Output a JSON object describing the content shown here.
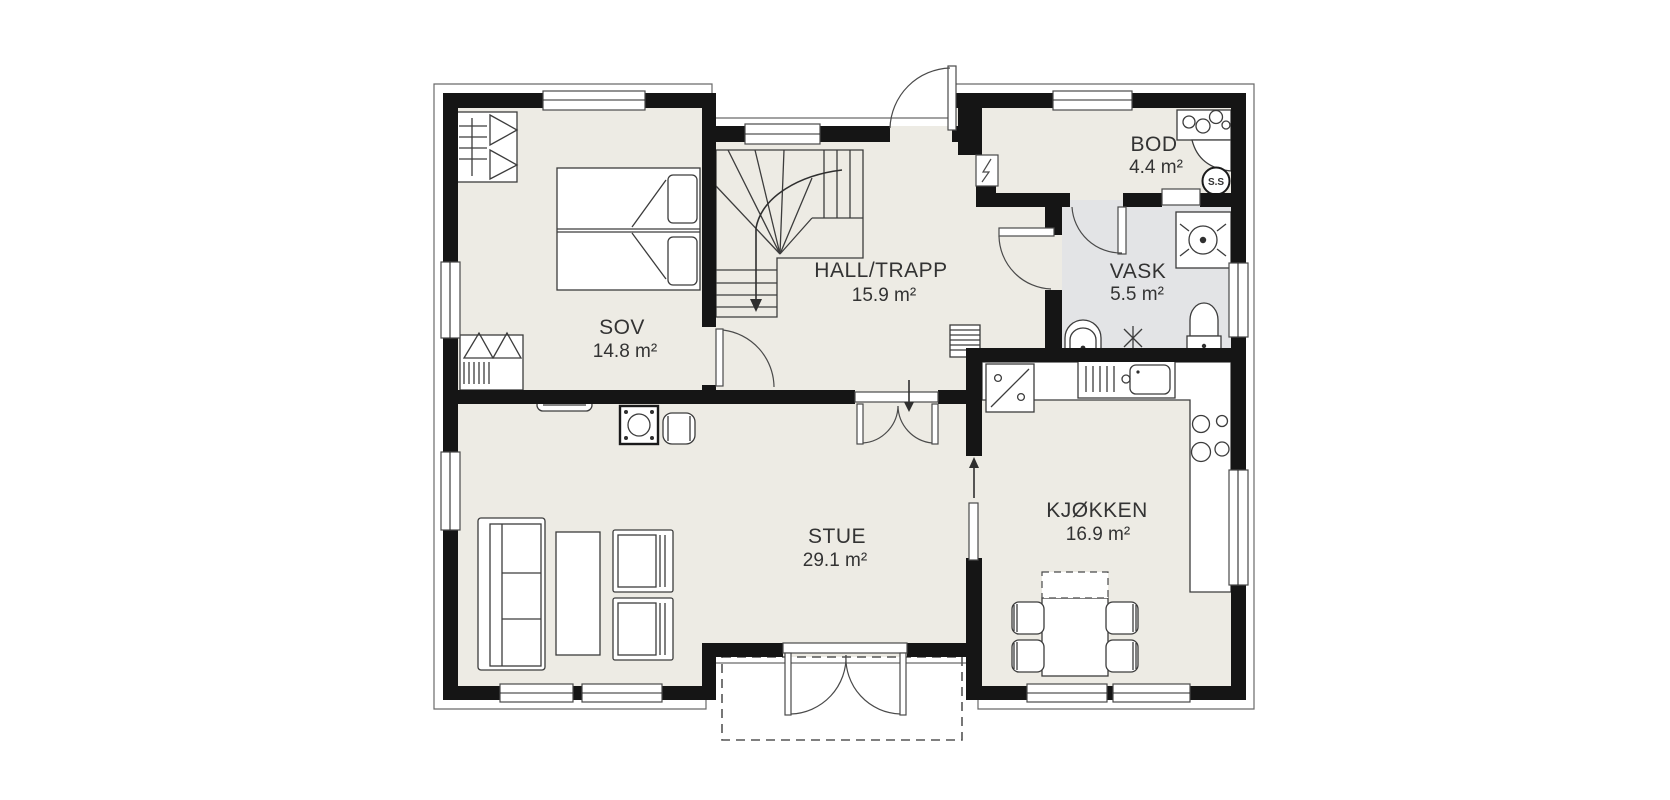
{
  "plan": {
    "type": "floor-plan",
    "language": "Norwegian",
    "rooms": [
      {
        "id": "sov",
        "name": "SOV",
        "area": "14.8 m²"
      },
      {
        "id": "hall",
        "name": "HALL/TRAPP",
        "area": "15.9 m²"
      },
      {
        "id": "bod",
        "name": "BOD",
        "area": "4.4 m²"
      },
      {
        "id": "vask",
        "name": "VASK",
        "area": "5.5 m²"
      },
      {
        "id": "stue",
        "name": "STUE",
        "area": "29.1 m²"
      },
      {
        "id": "kjokken",
        "name": "KJØKKEN",
        "area": "16.9 m²"
      }
    ],
    "labels": {
      "water_heater_tag": "S.S"
    },
    "colors": {
      "wall": "#151515",
      "floor": "#edebe4",
      "wet_room_floor": "#e3e4e6",
      "lines": "#3c3c3c",
      "text": "#333333",
      "background": "#ffffff"
    },
    "icons": [
      "bed-icon",
      "wardrobe-icon",
      "staircase-icon",
      "sofa-icon",
      "coffee-table-icon",
      "armchair-icon",
      "tv-icon",
      "woodstove-icon",
      "wood-basket-icon",
      "radiator-icon",
      "fuse-box-icon",
      "dishwasher-icon",
      "kitchen-sink-icon",
      "stove-icon",
      "dining-table-icon",
      "dining-chair-icon",
      "washbasin-icon",
      "floor-drain-icon",
      "toilet-icon",
      "ventilation-fan-icon",
      "water-heater-icon",
      "utility-appliance-icon",
      "ss-tank-icon",
      "window",
      "door-arc",
      "porch-outline"
    ]
  }
}
